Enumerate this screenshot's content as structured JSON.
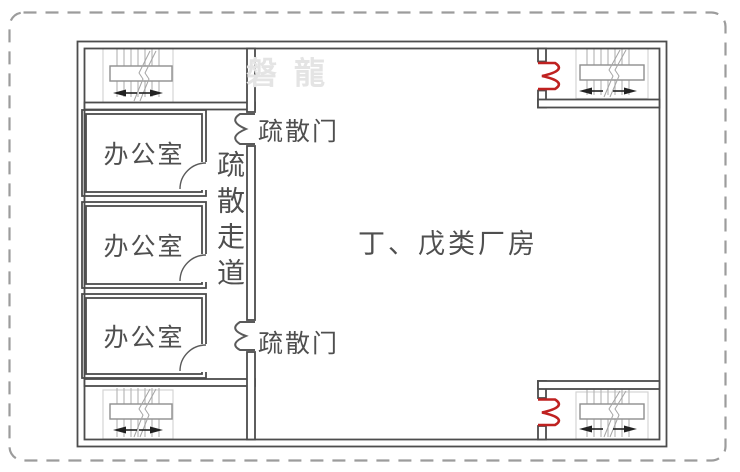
{
  "plan": {
    "title_area": "factory evacuation floor plan",
    "factory_label": "丁、戊类厂房",
    "corridor_label": "疏散走道",
    "offices": [
      "办公室",
      "办公室",
      "办公室"
    ],
    "evacuation_doors": [
      "疏散门",
      "疏散门"
    ],
    "watermark": "磐龍"
  },
  "icons": {
    "staircase": "stair-run-with-landing-and-break-line",
    "fire_door": "red-double-leaf-swing-door",
    "evac_door": "double-leaf-swing-door",
    "office_door": "quarter-arc-single-swing-door"
  },
  "colors": {
    "wall": "#4d4d4d",
    "door_gray": "#5a5a5a",
    "fire_door_red": "#bf2120",
    "stair_tread": "#b9b9b9",
    "stair_box": "#d4d4d4",
    "landing_edge": "#8f8f8f",
    "break_line": "#a5a5a5",
    "arrow": "#222222",
    "text": "#4f4f4f",
    "watermark": "#e4e4e4",
    "dash_border": "#9c9c9c",
    "background": "#ffffff"
  }
}
